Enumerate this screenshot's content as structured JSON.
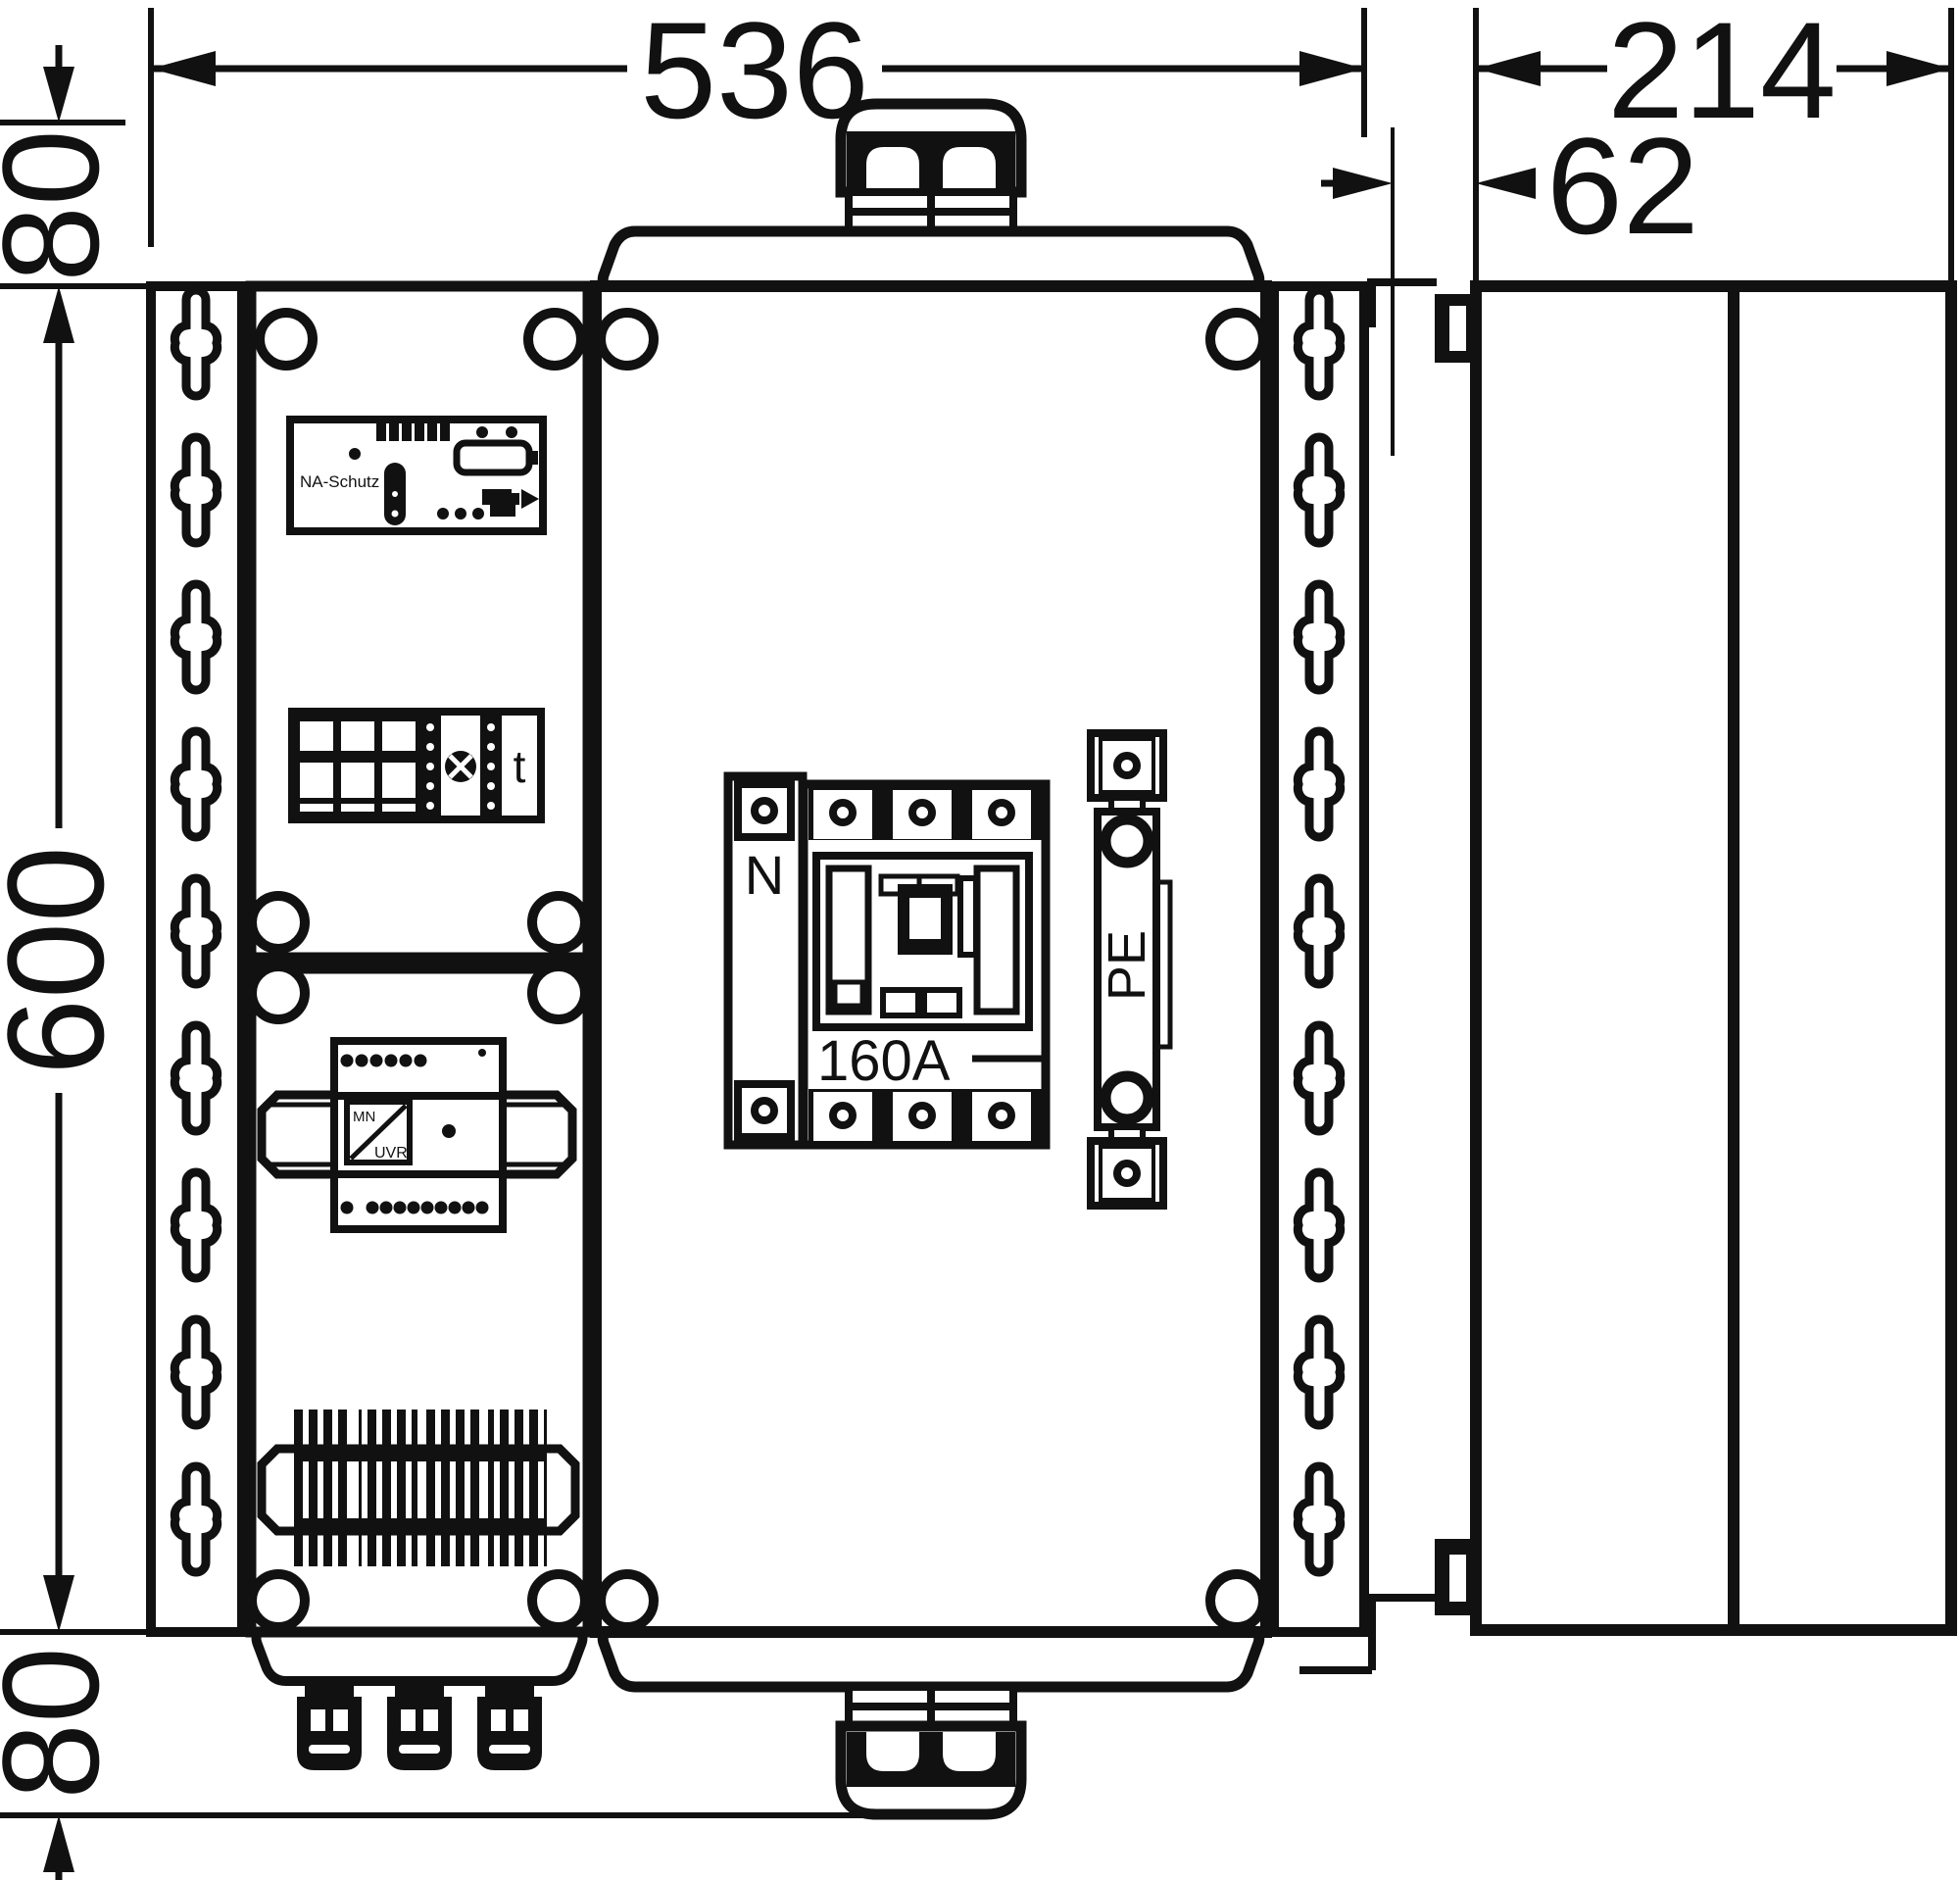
{
  "dimensions": {
    "width_total": "536",
    "top_offset": "80",
    "height_total": "600",
    "bottom_offset": "80",
    "depth_total": "214",
    "wall_offset": "62"
  },
  "labels": {
    "na_schutz": "NA-Schutz",
    "time_relay": "t",
    "neutral": "N",
    "breaker_rating": "160A",
    "pe_bar": "PE",
    "relay_mn": "MN",
    "relay_uvr": "UVR"
  },
  "colors": {
    "line": "#111111",
    "background": "#ffffff"
  }
}
